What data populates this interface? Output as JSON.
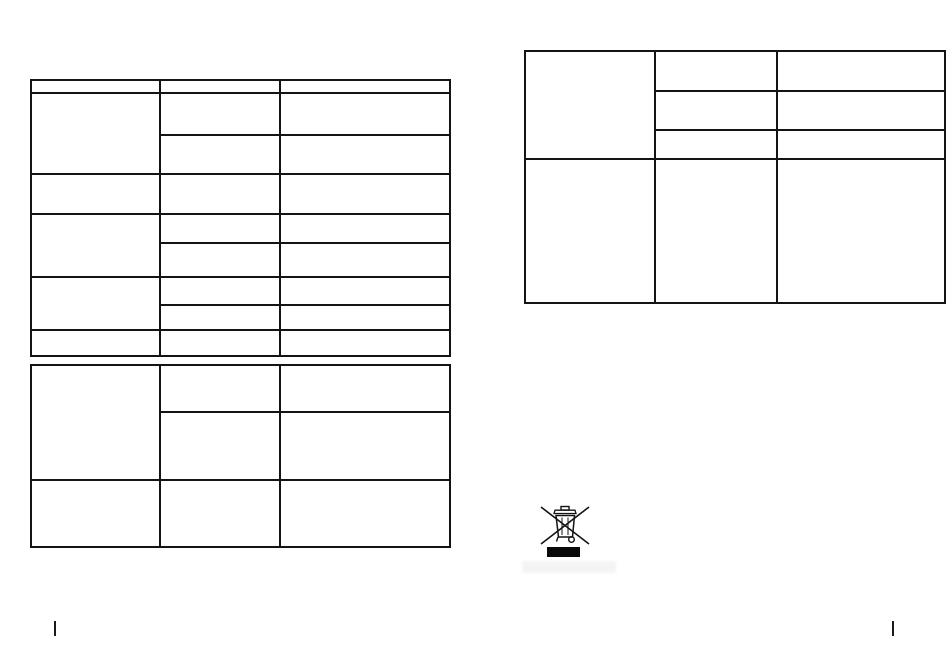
{
  "page": {
    "background_color": "#ffffff",
    "table_line_color": "#141414"
  },
  "tables": {
    "left_top_table": {
      "column_count": 3,
      "row_count": 9,
      "cells_empty": true,
      "cell_text": ""
    },
    "left_bottom_table": {
      "column_count": 3,
      "row_count": 3,
      "cells_empty": true,
      "cell_text": ""
    },
    "right_table": {
      "column_count": 3,
      "row_count": 4,
      "cells_empty": true,
      "cell_text": ""
    }
  },
  "weee_mark": {
    "icon": "crossed-out-wheeled-bin-icon",
    "bar_color": "#0a0a0a",
    "label_text": ""
  },
  "footer": {
    "left_fold_mark": "",
    "right_fold_mark": ""
  },
  "artifact": {
    "smudge_text": ""
  }
}
